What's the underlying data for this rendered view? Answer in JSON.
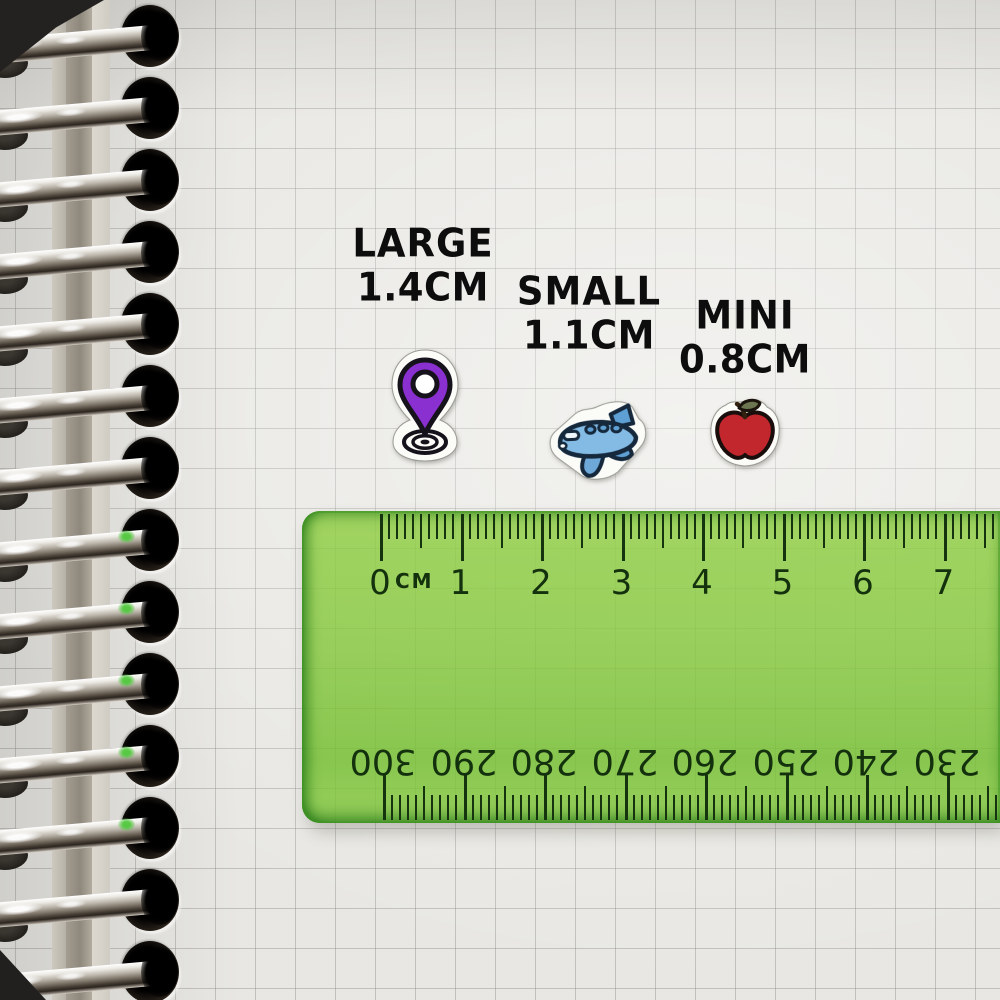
{
  "size_labels": [
    {
      "name": "LARGE",
      "size": "1.4CM"
    },
    {
      "name": "SMALL",
      "size": "1.1CM"
    },
    {
      "name": "MINI",
      "size": "0.8CM"
    }
  ],
  "stickers": [
    {
      "icon": "location-pin-sticker",
      "color": "#8a2fd0"
    },
    {
      "icon": "airplane-sticker",
      "color": "#6fa9d9"
    },
    {
      "icon": "apple-sticker",
      "color": "#c1272d"
    }
  ],
  "ruler": {
    "unit_label": "CM",
    "top_scale_numbers": [
      "0",
      "1",
      "2",
      "3",
      "4",
      "5",
      "6",
      "7"
    ],
    "bottom_scale_numbers": [
      "300",
      "290",
      "280",
      "270",
      "260",
      "250",
      "240",
      "230"
    ],
    "body_color": "#8dc63f",
    "marking_color": "#16330f"
  },
  "notebook": {
    "paper_color": "#e8e7e3",
    "grid_color": "#bfbeba",
    "coil_count": 15
  }
}
